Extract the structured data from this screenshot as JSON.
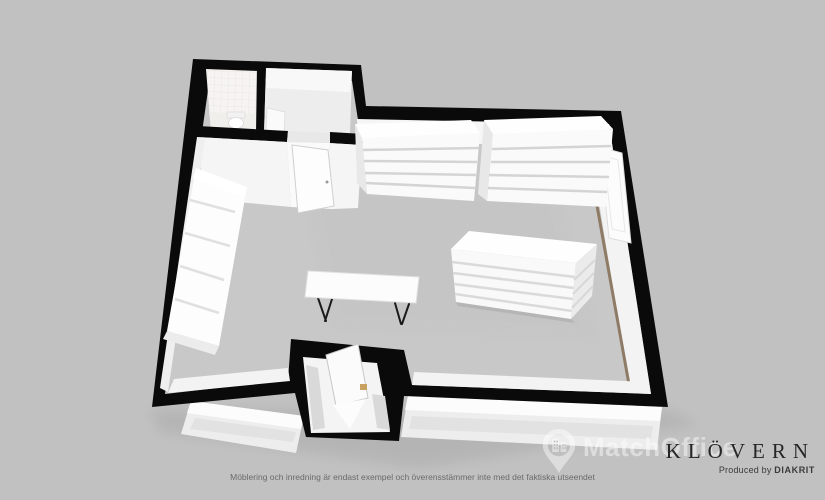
{
  "colors": {
    "background": "#c1c1c1",
    "wall": "#0a0a0a",
    "floor": "#c8c8c8",
    "interior_wall": "#f3f3f3",
    "furniture": "#fdfdfd",
    "wood_accent": "#8d7b66",
    "threshold_wood": "#c8a060",
    "window_pane": "#e2e2e2",
    "watermark": "rgba(255,255,255,0.45)",
    "brand_text": "#262626",
    "disclaimer_text": "#6a6a6a"
  },
  "watermark": {
    "label": "MatchOffice"
  },
  "branding": {
    "company": "KLÖVERN",
    "credit_prefix": "Produced by ",
    "producer": "DIAKRIT"
  },
  "disclaimer": "Möblering och inredning är endast exempel och överensstämmer inte med det faktiska utseendet"
}
